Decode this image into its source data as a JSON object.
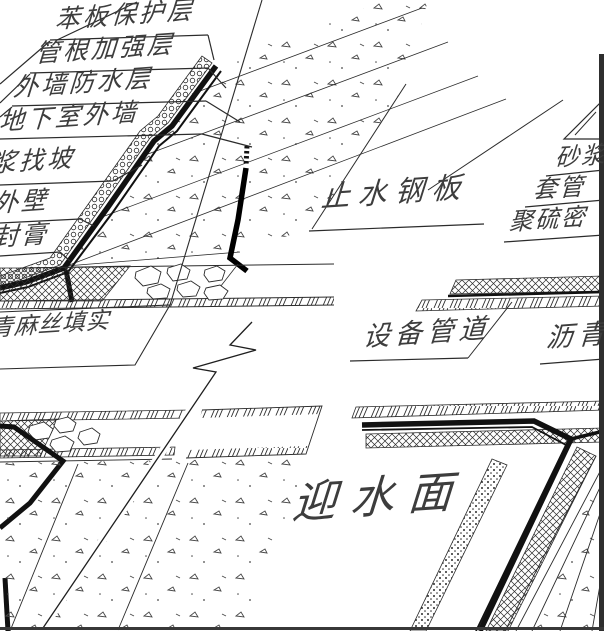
{
  "drawing": {
    "labels": {
      "left_stack": [
        "苯板保护层",
        "管根加强层",
        "外墙防水层",
        "地下室外墙"
      ],
      "mid_left_stack": [
        "浆找坡",
        "外壁",
        "封膏"
      ],
      "hemp_box": "青麻丝填实",
      "waterstop": "止水钢板",
      "right_stack": [
        "砂浆",
        "套管",
        "聚硫密"
      ],
      "pipe": "设备管道",
      "asphalt": "沥青",
      "water_face": "迎水面"
    },
    "colors": {
      "line": "#2b2b2b",
      "text": "#3d3d3d",
      "membrane": "#111111",
      "background": "#ffffff",
      "right_border": "#2e2e2e"
    }
  }
}
